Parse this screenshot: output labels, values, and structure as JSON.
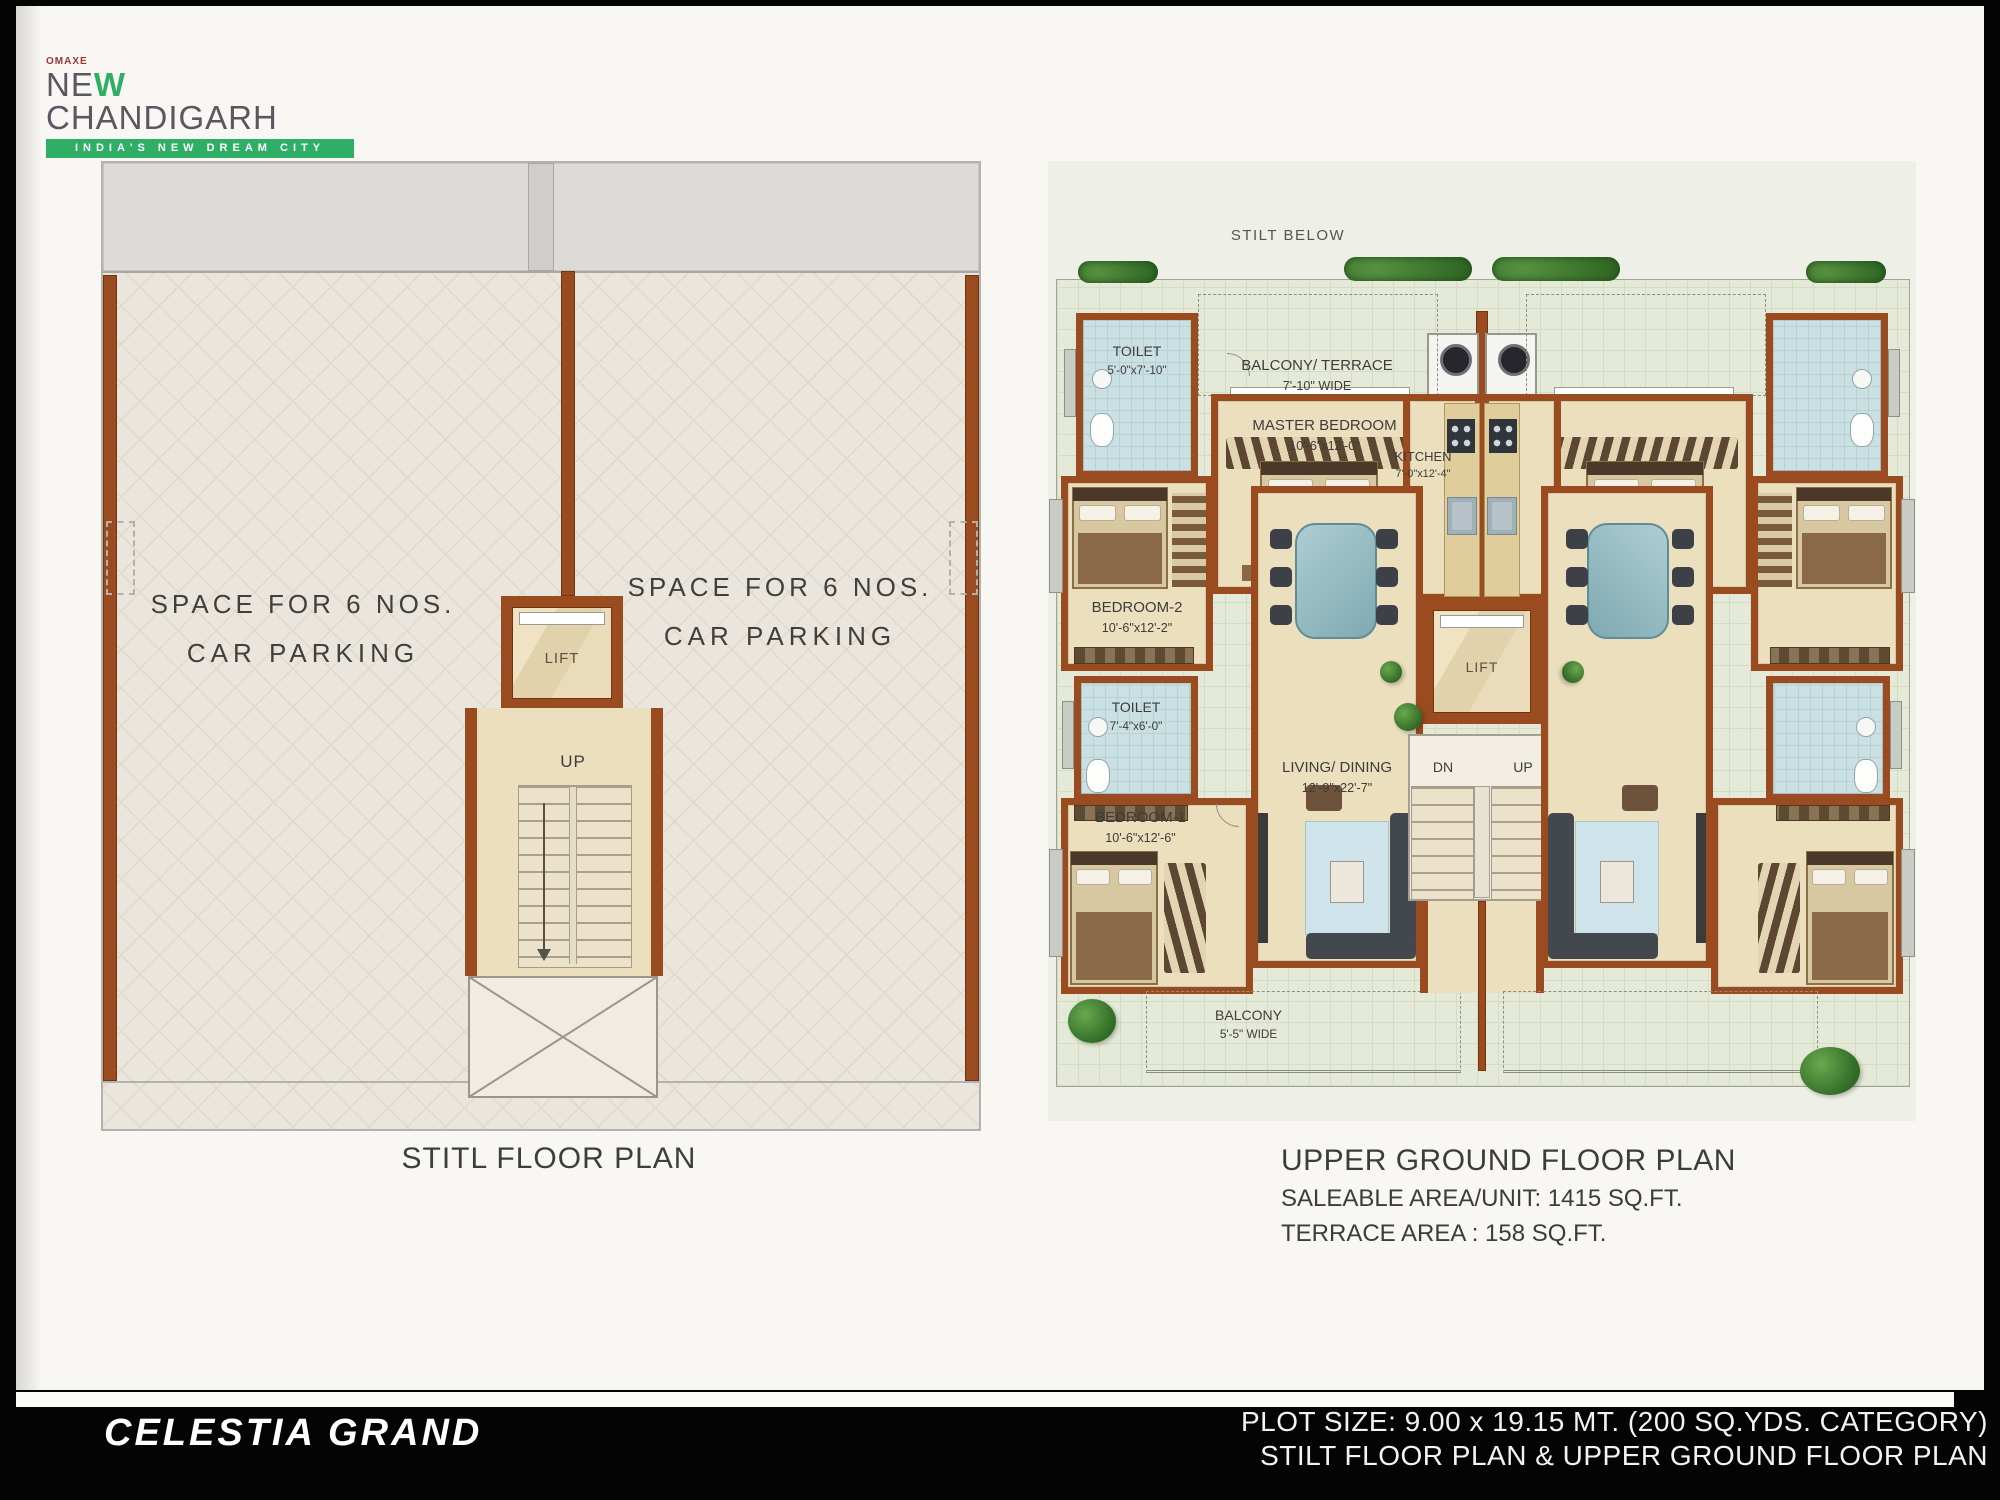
{
  "logo": {
    "brand": "OMAXE",
    "name_pre": "NE",
    "name_w": "W",
    "name_post": "CHANDIGARH",
    "tagline": "INDIA'S NEW DREAM CITY"
  },
  "stilt_plan": {
    "caption": "STITL FLOOR PLAN",
    "parking_left": {
      "line1": "SPACE FOR 6 NOS.",
      "line2": "CAR PARKING"
    },
    "parking_right": {
      "line1": "SPACE FOR 6 NOS.",
      "line2": "CAR PARKING"
    },
    "lift_label": "LIFT",
    "up_label": "UP"
  },
  "upper_plan": {
    "caption": "UPPER GROUND FLOOR PLAN",
    "saleable_area": "SALEABLE AREA/UNIT: 1415 SQ.FT.",
    "terrace_area": "TERRACE AREA : 158 SQ.FT.",
    "stilt_below": "STILT BELOW",
    "lift_label": "LIFT",
    "dn_label": "DN",
    "up_label": "UP",
    "rooms": {
      "toilet_top": {
        "name": "TOILET",
        "dim": "5'-0\"x7'-10\""
      },
      "balcony_terrace": {
        "name": "BALCONY/ TERRACE",
        "dim": "7'-10\" WIDE"
      },
      "master_bedroom": {
        "name": "MASTER BEDROOM",
        "dim": "10'-6\"x12'-0\""
      },
      "kitchen": {
        "name": "KITCHEN",
        "dim": "7'-0\"x12'-4\""
      },
      "bedroom_2": {
        "name": "BEDROOM-2",
        "dim": "10'-6\"x12'-2\""
      },
      "toilet_mid": {
        "name": "TOILET",
        "dim": "7'-4\"x6'-0\""
      },
      "living_dining": {
        "name": "LIVING/ DINING",
        "dim": "12'-9\"x22'-7\""
      },
      "bedroom_1": {
        "name": "BEDROOM-1",
        "dim": "10'-6\"x12'-6\""
      },
      "balcony": {
        "name": "BALCONY",
        "dim": "5'-5\" WIDE"
      }
    }
  },
  "footer": {
    "project_name": "CELESTIA GRAND",
    "plot_size": "PLOT SIZE: 9.00 x 19.15 MT. (200 SQ.YDS. CATEGORY)",
    "caption": "STILT FLOOR PLAN & UPPER GROUND FLOOR PLAN"
  },
  "colors": {
    "wall_brown": "#9b4b20",
    "floor_cream": "#ecdfbe",
    "tile_beige": "#ebe6dd",
    "terrace_green": "#e5ead8",
    "toilet_blue": "#cbe0e3",
    "logo_green": "#2fae66",
    "footer_bg": "#000000"
  }
}
